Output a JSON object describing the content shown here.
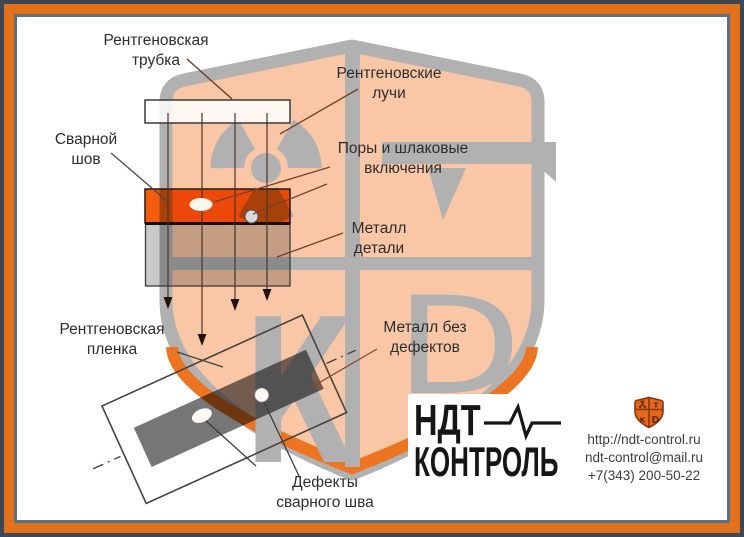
{
  "title": "Радиографический контроль сварного шва (схема)",
  "labels": {
    "xray_tube": "Рентгеновская\nтрубка",
    "weld_seam": "Сварной\nшов",
    "xray_rays": "Рентгеновские\nлучи",
    "pores": "Поры и шлаковые\nвключения",
    "metal_part": "Металл\nдетали",
    "film": "Рентгеновская\nпленка",
    "metal_no_defects": "Металл без\nдефектов",
    "weld_defects": "Дефекты\nсварного шва"
  },
  "logo": {
    "line1": "НДТ",
    "line2": "КОНТРОЛЬ"
  },
  "contact": {
    "website": "http://ndt-control.ru",
    "email": "ndt-control@mail.ru",
    "phone": "+7(343) 200-50-22"
  },
  "icons": {
    "watermark": "shield-with-radiation-trefoil-T-K-D",
    "logo_mark": "orange-shield-quadrants",
    "pulse": "heartbeat-line"
  },
  "colors": {
    "frame_outer": "#3c4853",
    "frame_band": "#e2711c",
    "frame_inner": "#5a7086",
    "background": "#ffffff",
    "watermark_fill": "#f9c7a6",
    "watermark_gray": "#b1b1b1",
    "watermark_inner_orange": "#ed7420",
    "weld_seam_orange": "#f25c0d",
    "metal_gray": "#c9c9c9",
    "film_strip_gray": "#767676",
    "leader_brown": "#7a3e28",
    "text": "#2d2d2d",
    "logo_black": "#161616"
  }
}
